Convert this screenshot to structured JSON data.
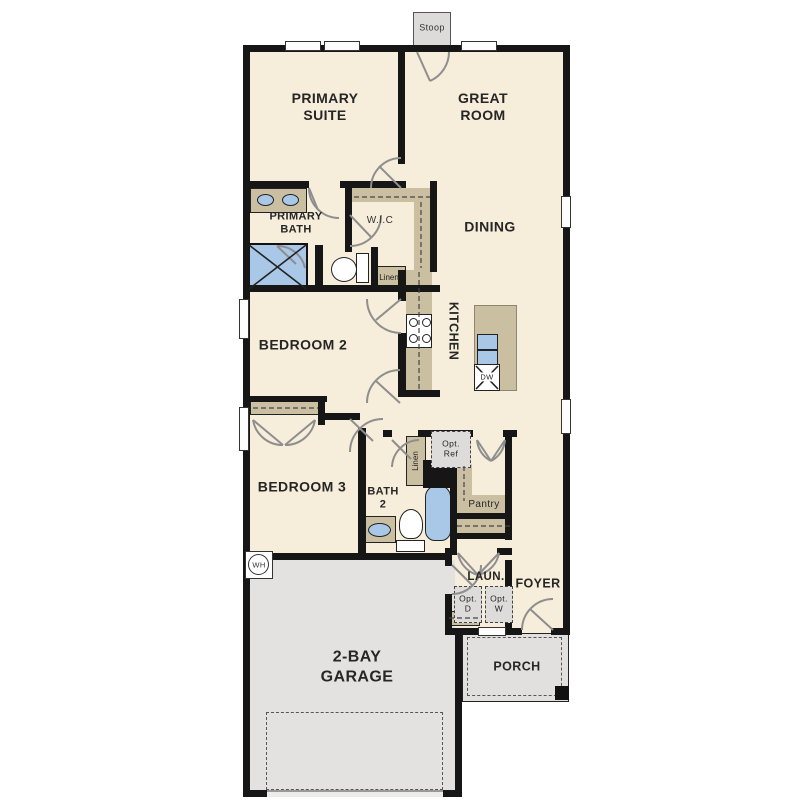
{
  "title": "Single-story floor plan",
  "colors": {
    "floor": "#f6edda",
    "wall": "#161616",
    "cabinet_tan": "#cbbfa2",
    "fixture_blue": "#a9c7e6",
    "garage_gray": "#e3e2e0",
    "door_arc_gray": "#8e8e8e"
  },
  "rooms": {
    "stoop": "Stoop",
    "primary_suite": "PRIMARY\nSUITE",
    "great_room": "GREAT\nROOM",
    "primary_bath": "PRIMARY\nBATH",
    "wic": "W.I.C",
    "linen_upper": "Linen",
    "dining": "DINING",
    "kitchen": "KITCHEN",
    "bedroom2": "BEDROOM 2",
    "bedroom3": "BEDROOM 3",
    "bath2": "BATH\n2",
    "linen_lower": "Linen",
    "pantry": "Pantry",
    "laundry": "LAUN.",
    "foyer": "FOYER",
    "porch": "PORCH",
    "garage": "2-BAY\nGARAGE"
  },
  "fixtures": {
    "opt_ref": "Opt.\nRef",
    "opt_dryer": "Opt.\nD",
    "opt_washer": "Opt.\nW",
    "dishwasher": "DW",
    "water_heater": "WH"
  }
}
